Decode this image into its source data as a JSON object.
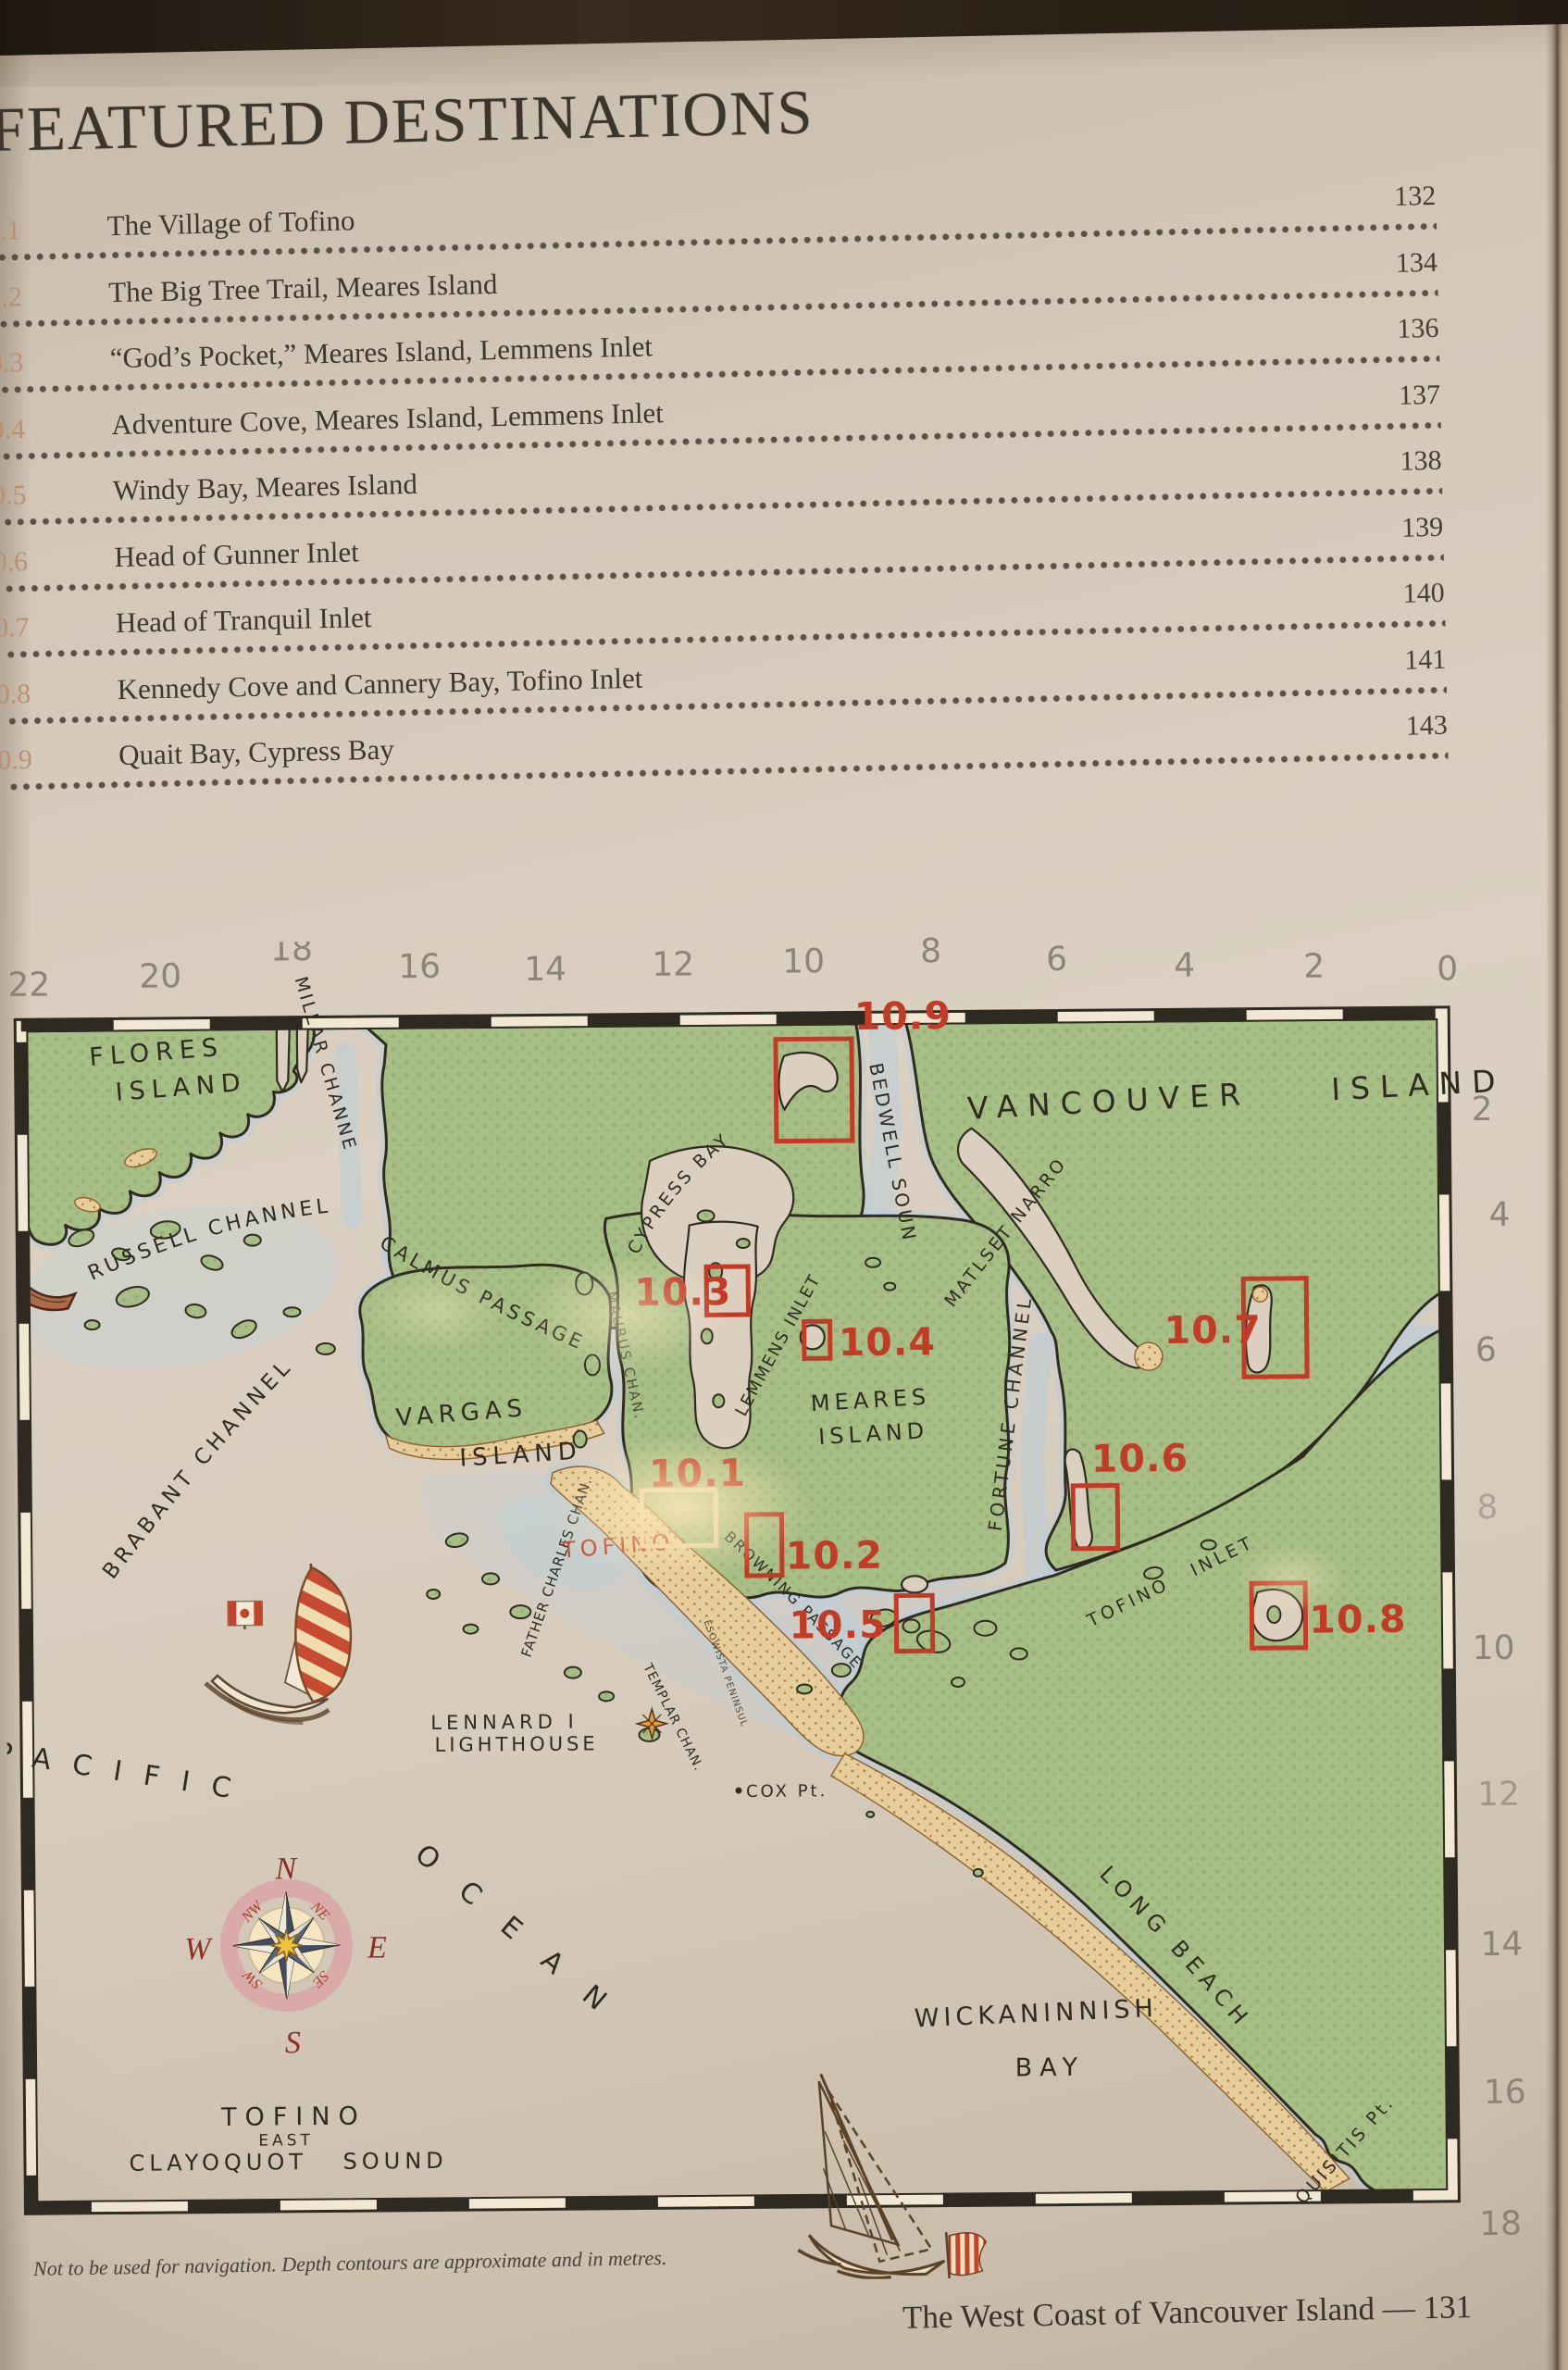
{
  "page": {
    "title": "FEATURED DESTINATIONS",
    "footnote": "Not to be used for navigation. Depth contours are approximate and in metres.",
    "running_footer": "The West Coast of Vancouver Island — 131"
  },
  "toc": {
    "entries": [
      {
        "num": "10.1",
        "label": "The Village of Tofino",
        "page": "132"
      },
      {
        "num": "10.2",
        "label": "The Big Tree Trail, Meares Island",
        "page": "134"
      },
      {
        "num": "10.3",
        "label": "“God’s Pocket,” Meares Island, Lemmens Inlet",
        "page": "136"
      },
      {
        "num": "10.4",
        "label": "Adventure Cove, Meares Island, Lemmens Inlet",
        "page": "137"
      },
      {
        "num": "10.5",
        "label": "Windy Bay, Meares Island",
        "page": "138"
      },
      {
        "num": "10.6",
        "label": "Head of Gunner Inlet",
        "page": "139"
      },
      {
        "num": "10.7",
        "label": "Head of Tranquil Inlet",
        "page": "140"
      },
      {
        "num": "10.8",
        "label": "Kennedy Cove and Cannery Bay, Tofino Inlet",
        "page": "141"
      },
      {
        "num": "10.9",
        "label": "Quait Bay, Cypress Bay",
        "page": "143"
      }
    ]
  },
  "map": {
    "top_scale": [
      "22",
      "20",
      "18",
      "16",
      "14",
      "12",
      "10",
      "8",
      "6",
      "4",
      "2",
      "0"
    ],
    "right_scale": [
      "2",
      "4",
      "6",
      "8",
      "10",
      "12",
      "14",
      "16",
      "18"
    ],
    "markers": [
      "10.1",
      "10.2",
      "10.3",
      "10.4",
      "10.5",
      "10.6",
      "10.7",
      "10.8",
      "10.9"
    ],
    "labels": {
      "flores_1": "FLORES",
      "flores_2": "ISLAND",
      "millar": "MILLAR CHANNEL",
      "vancouver_island": "VANCOUVER ISLAND",
      "cypress_bay": "CYPRESS BAY",
      "bedwell": "BEDWELL SOUND",
      "matset": "MATLSET NARROWS",
      "russell": "RUSSELL CHANNEL",
      "calmus": "CALMUS PASSAGE",
      "brabant": "BRABANT CHANNEL",
      "vargas_1": "VARGAS",
      "vargas_2": "ISLAND",
      "meares_1": "MEARES",
      "meares_2": "ISLAND",
      "lemmens": "LEMMENS INLET",
      "fortune": "FORTUNE CHANNEL",
      "maurus": "MAURUS CHAN.",
      "father_charles": "FATHER CHARLES CHAN.",
      "templar": "TEMPLAR CHAN.",
      "esowista": "ESOWISTA PENINSULA",
      "browning": "BROWNING PASSAGE",
      "tofino_town": "TOFINO",
      "tofino_inlet": "TOFINO  INLET",
      "lennard_1": "LENNARD I",
      "lennard_2": "LIGHTHOUSE",
      "cox_pt": "COX Pt.",
      "pacific": "PACIFIC",
      "ocean": "OCEAN",
      "wickaninnish_1": "WICKANINNISH",
      "wickaninnish_2": "BAY",
      "long_beach": "LONG BEACH",
      "quisitis": "QUISITIS Pt.",
      "sound_1": "TOFINO",
      "sound_2": "EAST",
      "sound_3": "CLAYOQUOT SOUND"
    },
    "compass": {
      "n": "N",
      "e": "E",
      "s": "S",
      "w": "W",
      "nw": "NW",
      "ne": "NE",
      "sw": "SW",
      "se": "SE"
    },
    "colors": {
      "marker_red": "#c13b27",
      "land_green": "#a8be87",
      "water_blue": "#b9cfdf",
      "sand": "#e9cf9e",
      "ink": "#2f2b20"
    }
  }
}
